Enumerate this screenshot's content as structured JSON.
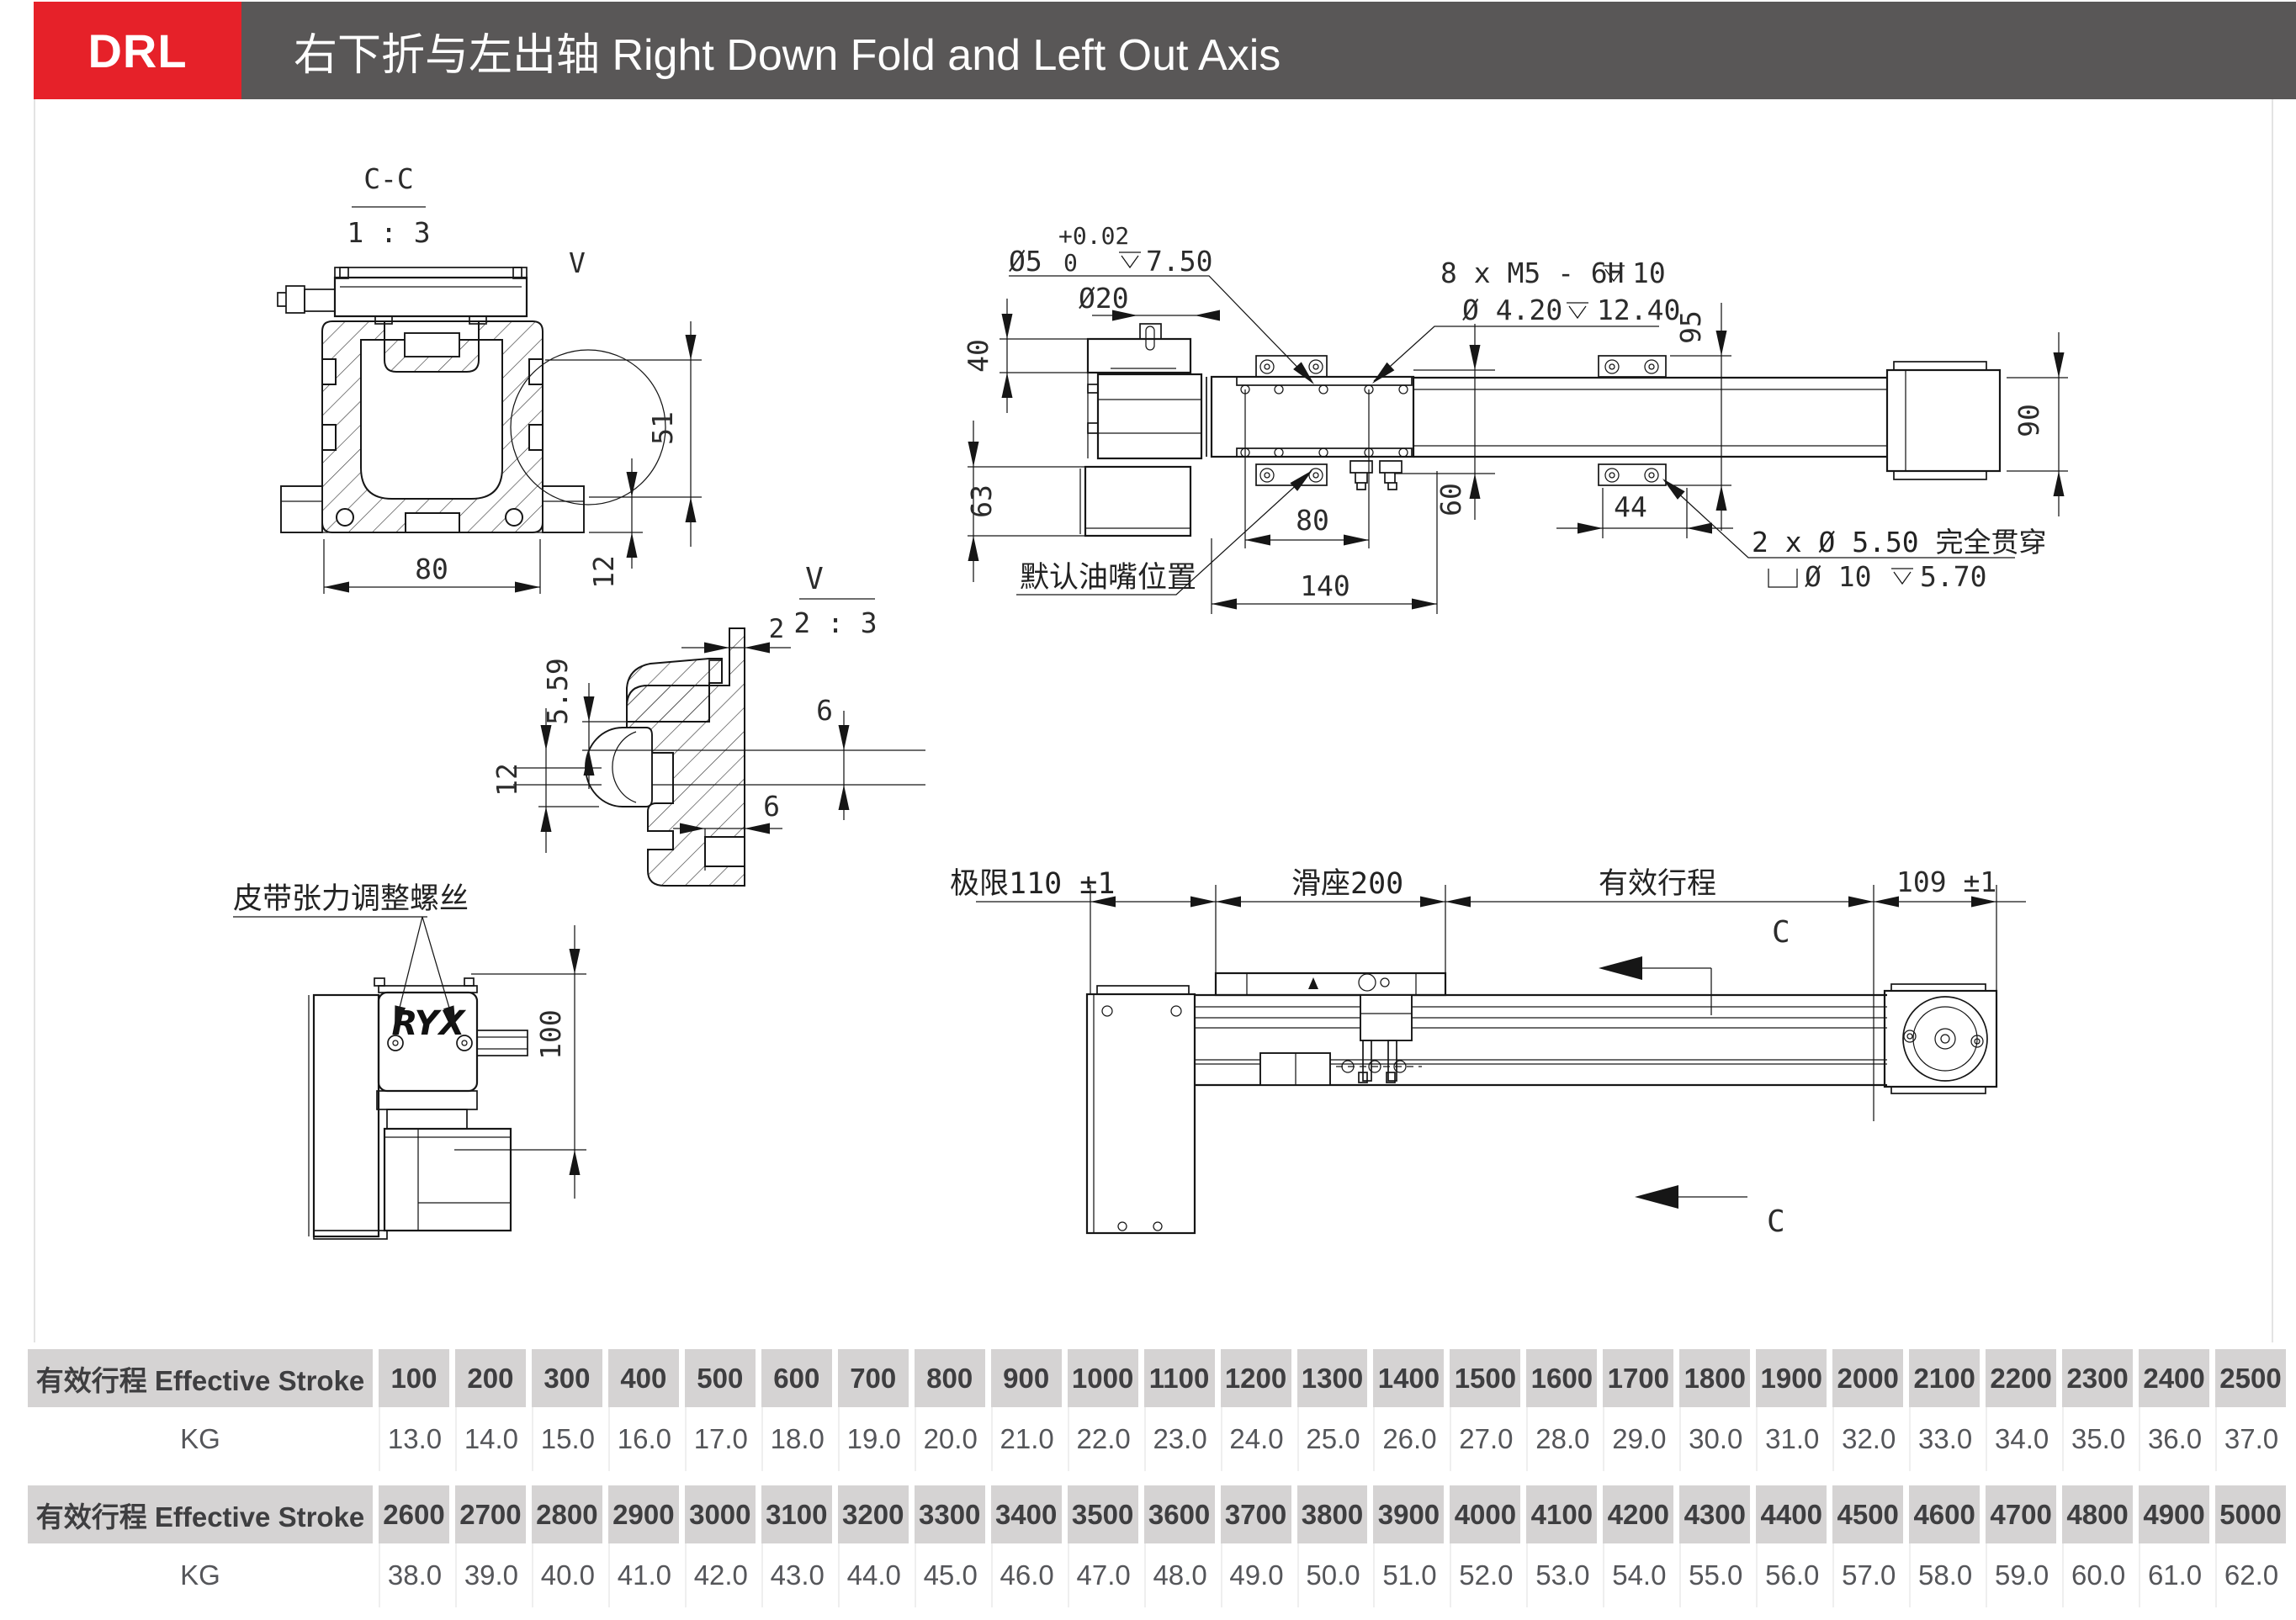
{
  "header": {
    "badge": "DRL",
    "title": "右下折与左出轴 Right Down Fold and Left Out Axis"
  },
  "drawings": {
    "cc": {
      "title": "C-C",
      "scale": "1 : 3",
      "v": "V",
      "d51": "51",
      "d12": "12",
      "d80": "80"
    },
    "side": {
      "tol": "+0.02",
      "dia5": "Ø5",
      "zero": "0",
      "dep750": "7.50",
      "dia20": "Ø20",
      "thread": "8 x  M5 - 6H",
      "dep10": "10",
      "dia420": "Ø 4.20",
      "dep1240": "12.40",
      "d40": "40",
      "d63": "63",
      "d60": "60",
      "d80": "80",
      "d140": "140",
      "d44": "44",
      "d95": "95",
      "d90": "90",
      "through": "2 x  Ø 5.50  完全贯穿",
      "dia10": "Ø 10",
      "dep570": "5.70",
      "oil": "默认油嘴位置"
    },
    "vdet": {
      "v": "V",
      "scale": "2 : 3",
      "d2": "2",
      "d559": "5.59",
      "d12": "12",
      "d6a": "6",
      "d6b": "6"
    },
    "motor": {
      "belt": "皮带张力调整螺丝",
      "d100": "100",
      "logo": "RYX"
    },
    "top": {
      "limit": "极限110 ±1",
      "slide": "滑座200",
      "stroke": "有效行程",
      "d109": "109 ±1",
      "c": "C"
    }
  },
  "table": {
    "row_label": "有效行程 Effective Stroke",
    "kg_label": "KG",
    "sections": [
      {
        "strokes": [
          "100",
          "200",
          "300",
          "400",
          "500",
          "600",
          "700",
          "800",
          "900",
          "1000",
          "1100",
          "1200",
          "1300",
          "1400",
          "1500",
          "1600",
          "1700",
          "1800",
          "1900",
          "2000",
          "2100",
          "2200",
          "2300",
          "2400",
          "2500"
        ],
        "kg": [
          "13.0",
          "14.0",
          "15.0",
          "16.0",
          "17.0",
          "18.0",
          "19.0",
          "20.0",
          "21.0",
          "22.0",
          "23.0",
          "24.0",
          "25.0",
          "26.0",
          "27.0",
          "28.0",
          "29.0",
          "30.0",
          "31.0",
          "32.0",
          "33.0",
          "34.0",
          "35.0",
          "36.0",
          "37.0"
        ]
      },
      {
        "strokes": [
          "2600",
          "2700",
          "2800",
          "2900",
          "3000",
          "3100",
          "3200",
          "3300",
          "3400",
          "3500",
          "3600",
          "3700",
          "3800",
          "3900",
          "4000",
          "4100",
          "4200",
          "4300",
          "4400",
          "4500",
          "4600",
          "4700",
          "4800",
          "4900",
          "5000"
        ],
        "kg": [
          "38.0",
          "39.0",
          "40.0",
          "41.0",
          "42.0",
          "43.0",
          "44.0",
          "45.0",
          "46.0",
          "47.0",
          "48.0",
          "49.0",
          "50.0",
          "51.0",
          "52.0",
          "53.0",
          "54.0",
          "55.0",
          "56.0",
          "57.0",
          "58.0",
          "59.0",
          "60.0",
          "61.0",
          "62.0"
        ]
      }
    ]
  }
}
